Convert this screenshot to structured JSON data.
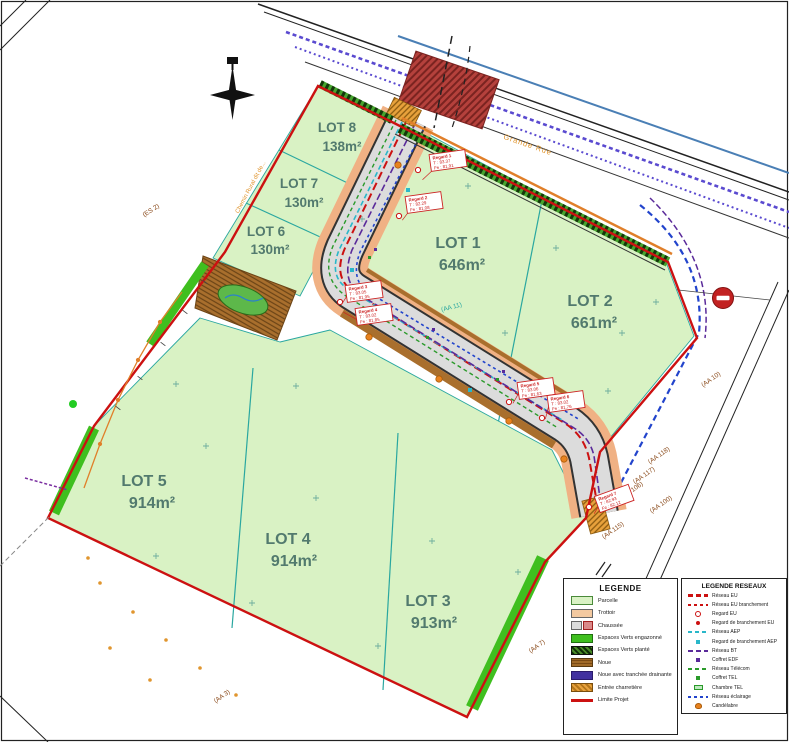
{
  "streets": {
    "grande_rue": "Grande Rue",
    "chemin_rural": "Chemin Rural dit de..."
  },
  "lots": [
    {
      "name": "LOT 1",
      "area": "646m²"
    },
    {
      "name": "LOT 2",
      "area": "661m²"
    },
    {
      "name": "LOT 3",
      "area": "913m²"
    },
    {
      "name": "LOT 4",
      "area": "914m²"
    },
    {
      "name": "LOT 5",
      "area": "914m²"
    },
    {
      "name": "LOT 6",
      "area": "130m²"
    },
    {
      "name": "LOT 7",
      "area": "130m²"
    },
    {
      "name": "LOT 8",
      "area": "138m²"
    }
  ],
  "parcels": {
    "es2": "(ES 2)",
    "aa11": "(AA 11)",
    "aa10": "(AA 10)",
    "aa118": "(AA 118)",
    "aa117": "(AA 117)",
    "aa106": "(AA 106)",
    "aa100": "(AA 100)",
    "aa115": "(AA 115)",
    "aa7": "(AA 7)",
    "aa3": "(AA 3)"
  },
  "regards": [
    {
      "id": "Regard 1",
      "t": "T : 83.37",
      "fe": "Fe : 81.91"
    },
    {
      "id": "Regard 2",
      "t": "T : 82.29",
      "fe": "Fe : 81.08"
    },
    {
      "id": "Regard 3",
      "t": "T : 83.05",
      "fe": "Fe : 81.95"
    },
    {
      "id": "Regard 4",
      "t": "T : 83.02",
      "fe": "Fe : 81.85"
    },
    {
      "id": "Regard 5",
      "t": "T : 83.06",
      "fe": "Fe : 81.63"
    },
    {
      "id": "Regard 6",
      "t": "T : 83.02",
      "fe": "Fe : 81.76"
    },
    {
      "id": "Regard 7",
      "t": "T : 82.93",
      "fe": "Fe : 82.12"
    }
  ],
  "legend": {
    "title": "LEGENDE",
    "items": [
      {
        "label": "Parcelle"
      },
      {
        "label": "Trottoir"
      },
      {
        "label": "Chaussée"
      },
      {
        "label": "Espaces Verts engazonné"
      },
      {
        "label": "Espaces Verts planté"
      },
      {
        "label": "Noue"
      },
      {
        "label": "Noue avec tranchée drainante"
      },
      {
        "label": "Entrée charretière"
      },
      {
        "label": "Limite Projet"
      }
    ]
  },
  "legend_reseaux": {
    "title": "LEGENDE RESEAUX",
    "items": [
      {
        "label": "Réseau EU"
      },
      {
        "label": "Réseau EU branchement"
      },
      {
        "label": "Regard EU"
      },
      {
        "label": "Regard de branchement EU"
      },
      {
        "label": "Réseau AEP"
      },
      {
        "label": "Regard de branchement AEP"
      },
      {
        "label": "Réseau BT"
      },
      {
        "label": "Coffret EDF"
      },
      {
        "label": "Réseau Télécom"
      },
      {
        "label": "Coffret TEL"
      },
      {
        "label": "Chambre TEL"
      },
      {
        "label": "Réseau éclairage"
      },
      {
        "label": "Candélabre"
      }
    ]
  },
  "colors": {
    "limite_projet": "#cc1111",
    "parcelle": "#d9f2c4",
    "trottoir": "#f0b184",
    "espaces_verts": "#3fbf1f",
    "noue": "#a06a28",
    "reseau_eu": "#cc1111",
    "reseau_aep": "#29b7c9",
    "reseau_bt": "#5a2a9a",
    "reseau_telecom": "#2a9a2a",
    "reseau_eclairage": "#2244cc",
    "candelabre": "#e8821e"
  }
}
